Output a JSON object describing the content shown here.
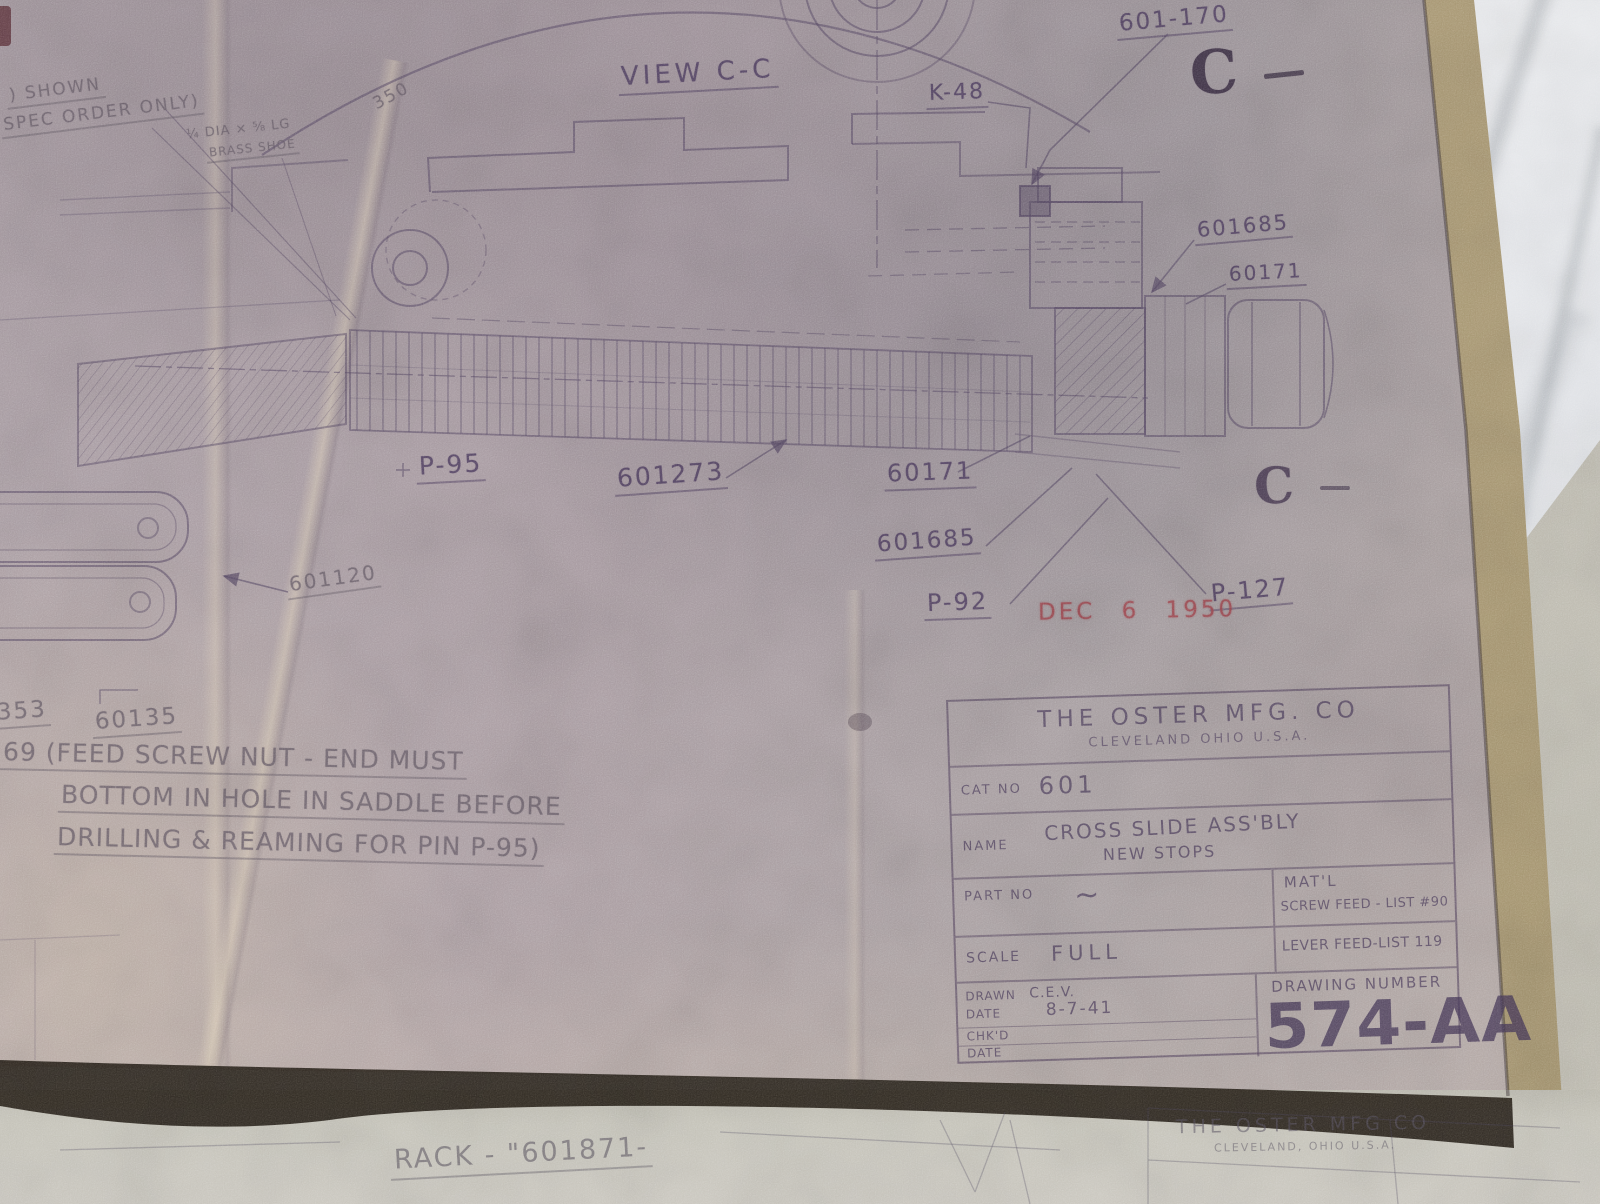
{
  "annotations": {
    "view_label": "VIEW C-C",
    "section_letter": "C",
    "k48": "K-48",
    "part_601_170": "601-170",
    "part_601685_top": "601685",
    "part_60171_top": "60171",
    "part_p95": "P-95",
    "part_601273": "601273",
    "part_60171_mid": "60171",
    "part_601685_mid": "601685",
    "part_p92": "P-92",
    "part_p127": "P-127",
    "part_601120": "601120",
    "part_350": "350",
    "part_353": "353",
    "part_60135": "60135",
    "stamp_date": "DEC 6 1950",
    "note_shown_1": ") SHOWN",
    "note_shown_2": "SPEC ORDER ONLY)",
    "note_brass_1": "¼ DIA × ⅝ LG",
    "note_brass_2": "BRASS SHOE",
    "note_feed_1": "69 (FEED SCREW NUT - END MUST",
    "note_feed_2": "BOTTOM IN HOLE IN SADDLE BEFORE",
    "note_feed_3": "DRILLING & REAMING FOR PIN P-95)"
  },
  "title_block": {
    "company": "THE OSTER MFG. CO",
    "location": "CLEVELAND OHIO U.S.A.",
    "cat_no_label": "CAT NO",
    "cat_no": "601",
    "name_label": "NAME",
    "name_line1": "CROSS SLIDE ASS'BLY",
    "name_line2": "NEW STOPS",
    "part_no_label": "PART NO",
    "part_no_value": "~",
    "mat_label": "MAT'L",
    "mat_note1": "SCREW FEED - LIST #90",
    "mat_note2": "LEVER FEED-LIST 119",
    "scale_label": "SCALE",
    "scale_value": "FULL",
    "drawn_label": "DRAWN",
    "drawn_value": "C.E.V.",
    "date_label": "DATE",
    "date_value": "8-7-41",
    "chkd_label": "CHK'D",
    "date2_label": "DATE",
    "drawing_number_label": "DRAWING NUMBER",
    "drawing_number": "574-AA"
  },
  "bottom_sheet": {
    "rack_note": "RACK - \"601871-",
    "company": "THE OSTER MFG CO",
    "location": "CLEVELAND, OHIO U.S.A."
  },
  "colors": {
    "ink": "#544662",
    "pencil": "#625864",
    "stamp_red": "#9e444c",
    "paper": "#a89ba2",
    "fold": "#d6c8b2",
    "edge_tan": "#b3a17e",
    "marble": "#e9ebee",
    "under_sheet": "#c6c3b8",
    "shadow": "#2b251e"
  }
}
